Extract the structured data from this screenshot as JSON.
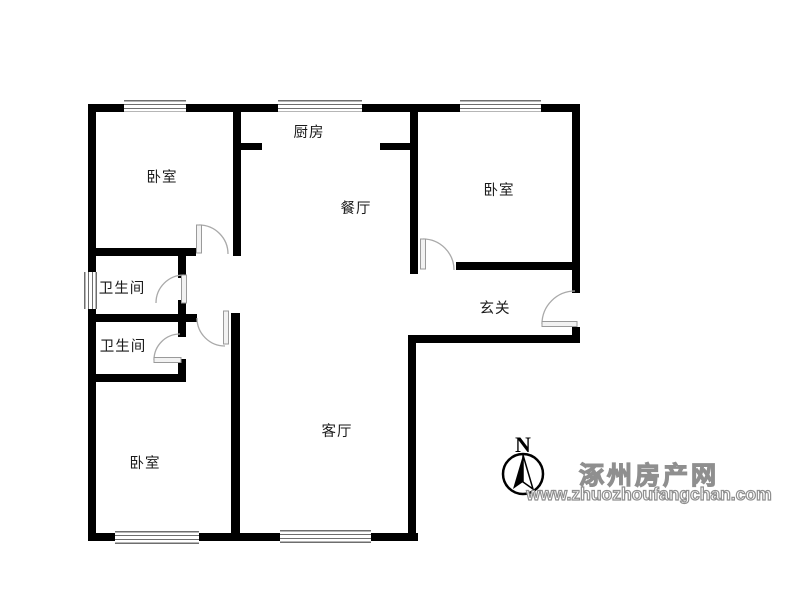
{
  "rooms": {
    "bedroom_top_left": "卧室",
    "kitchen": "厨房",
    "bedroom_top_right": "卧室",
    "dining": "餐厅",
    "bathroom_upper": "卫生间",
    "entry_hall": "玄关",
    "bathroom_lower": "卫生间",
    "living": "客厅",
    "bedroom_bottom_left": "卧室"
  },
  "compass": {
    "north_label": "N"
  },
  "watermark": {
    "site_name": "涿州房产网",
    "site_url": "www.zhuozhoufangchan.com"
  },
  "colors": {
    "wall": "#000000",
    "door_line": "#a9a9a9",
    "watermark_gray": "#8f8f8f",
    "label_text": "#1a1a1a"
  }
}
